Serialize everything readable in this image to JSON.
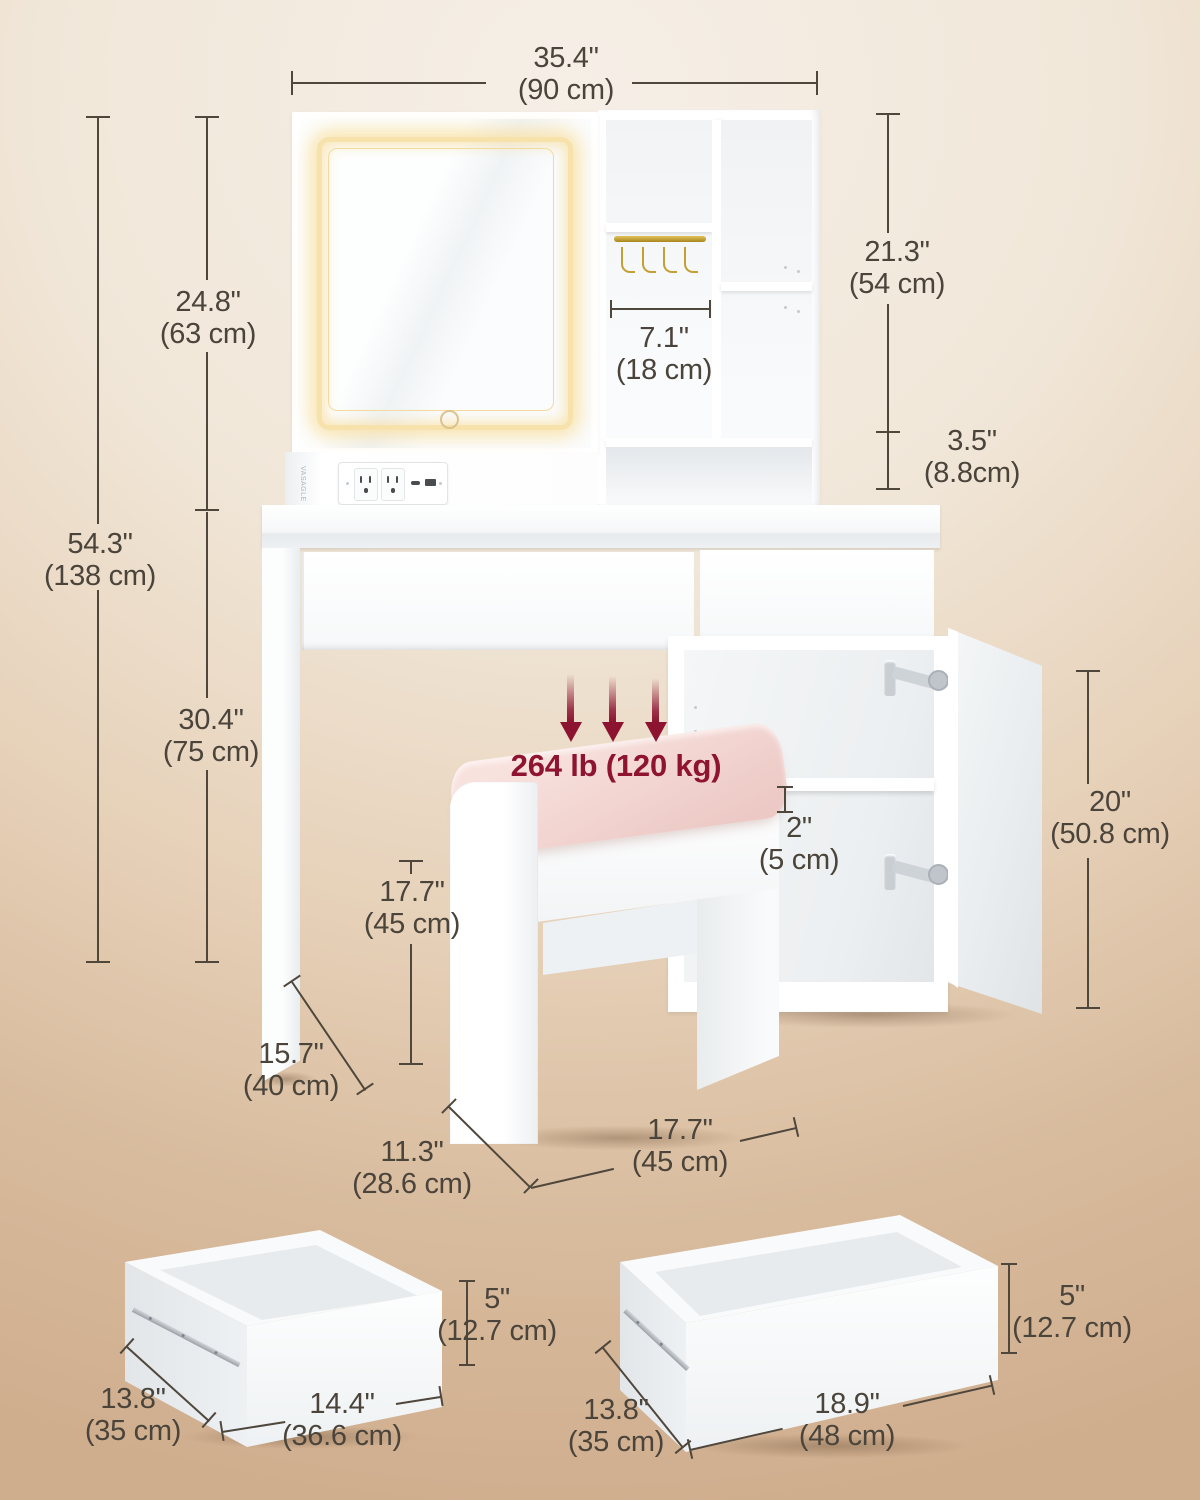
{
  "brand": "VASAGLE",
  "weight_capacity": "264 lb (120 kg)",
  "colors": {
    "background_top": "#f6efe7",
    "background_bottom": "#cfae8e",
    "ink": "#4b443b",
    "accent_red": "#8e1430",
    "cushion_pink": "#f3d6d2",
    "led_glow": "#f7e2ac",
    "gold_rod": "#c3a034",
    "furniture_white": "#ffffff"
  },
  "dims": {
    "overall_width": {
      "in": "35.4\"",
      "cm": "(90 cm)"
    },
    "mirror_height": {
      "in": "24.8\"",
      "cm": "(63 cm)"
    },
    "overall_height": {
      "in": "54.3\"",
      "cm": "(138 cm)"
    },
    "desk_height": {
      "in": "30.4\"",
      "cm": "(75 cm)"
    },
    "hutch_height": {
      "in": "21.3\"",
      "cm": "(54 cm)"
    },
    "shelf_clearance": {
      "in": "3.5\"",
      "cm": "(8.8cm)"
    },
    "compartment_width": {
      "in": "7.1\"",
      "cm": "(18 cm)"
    },
    "cushion_thickness": {
      "in": "2\"",
      "cm": "(5 cm)"
    },
    "door_height": {
      "in": "20\"",
      "cm": "(50.8 cm)"
    },
    "stool_height": {
      "in": "17.7\"",
      "cm": "(45 cm)"
    },
    "desk_depth": {
      "in": "15.7\"",
      "cm": "(40 cm)"
    },
    "stool_depth": {
      "in": "11.3\"",
      "cm": "(28.6 cm)"
    },
    "stool_width": {
      "in": "17.7\"",
      "cm": "(45 cm)"
    },
    "drawer_small": {
      "depth_in": "13.8\"",
      "depth_cm": "(35 cm)",
      "width_in": "14.4\"",
      "width_cm": "(36.6 cm)",
      "height_in": "5\"",
      "height_cm": "(12.7 cm)"
    },
    "drawer_large": {
      "depth_in": "13.8\"",
      "depth_cm": "(35 cm)",
      "width_in": "18.9\"",
      "width_cm": "(48 cm)",
      "height_in": "5\"",
      "height_cm": "(12.7 cm)"
    }
  }
}
